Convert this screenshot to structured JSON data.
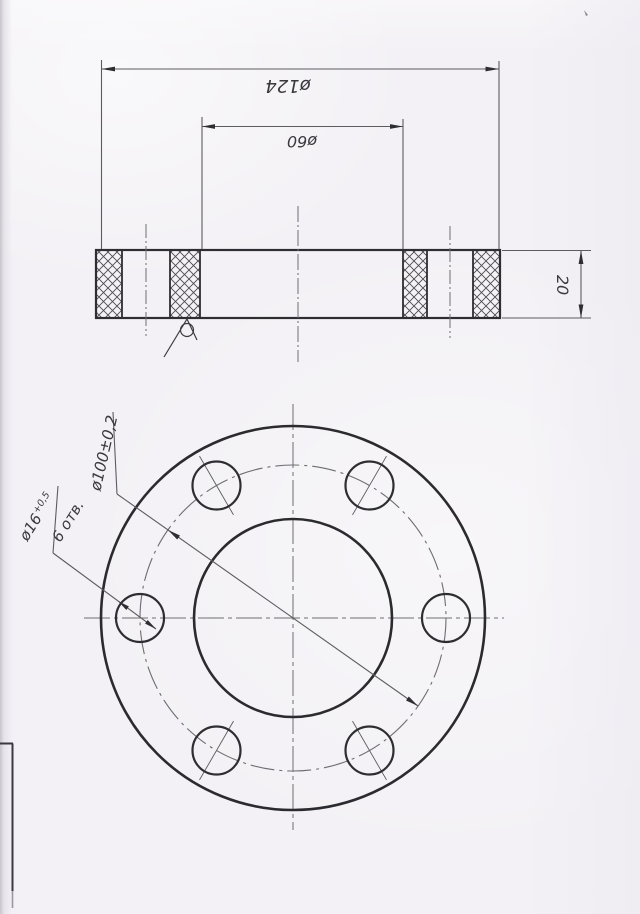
{
  "drawing": {
    "section_view": {
      "dim_outer_diameter": "ø124",
      "dim_bore_diameter": "ø60",
      "dim_thickness": "20"
    },
    "plan_view": {
      "dim_bolt_circle_diameter": "ø100±0,2",
      "hole_note_diameter": "ø16",
      "hole_note_tolerance": "+0,5",
      "hole_note_count": "6 отв."
    },
    "colors": {
      "paper": "#f3f1f5",
      "ink_thick": "#2e2d31",
      "ink_thin": "#5c5b60",
      "centerline": "#6e6d73"
    }
  }
}
